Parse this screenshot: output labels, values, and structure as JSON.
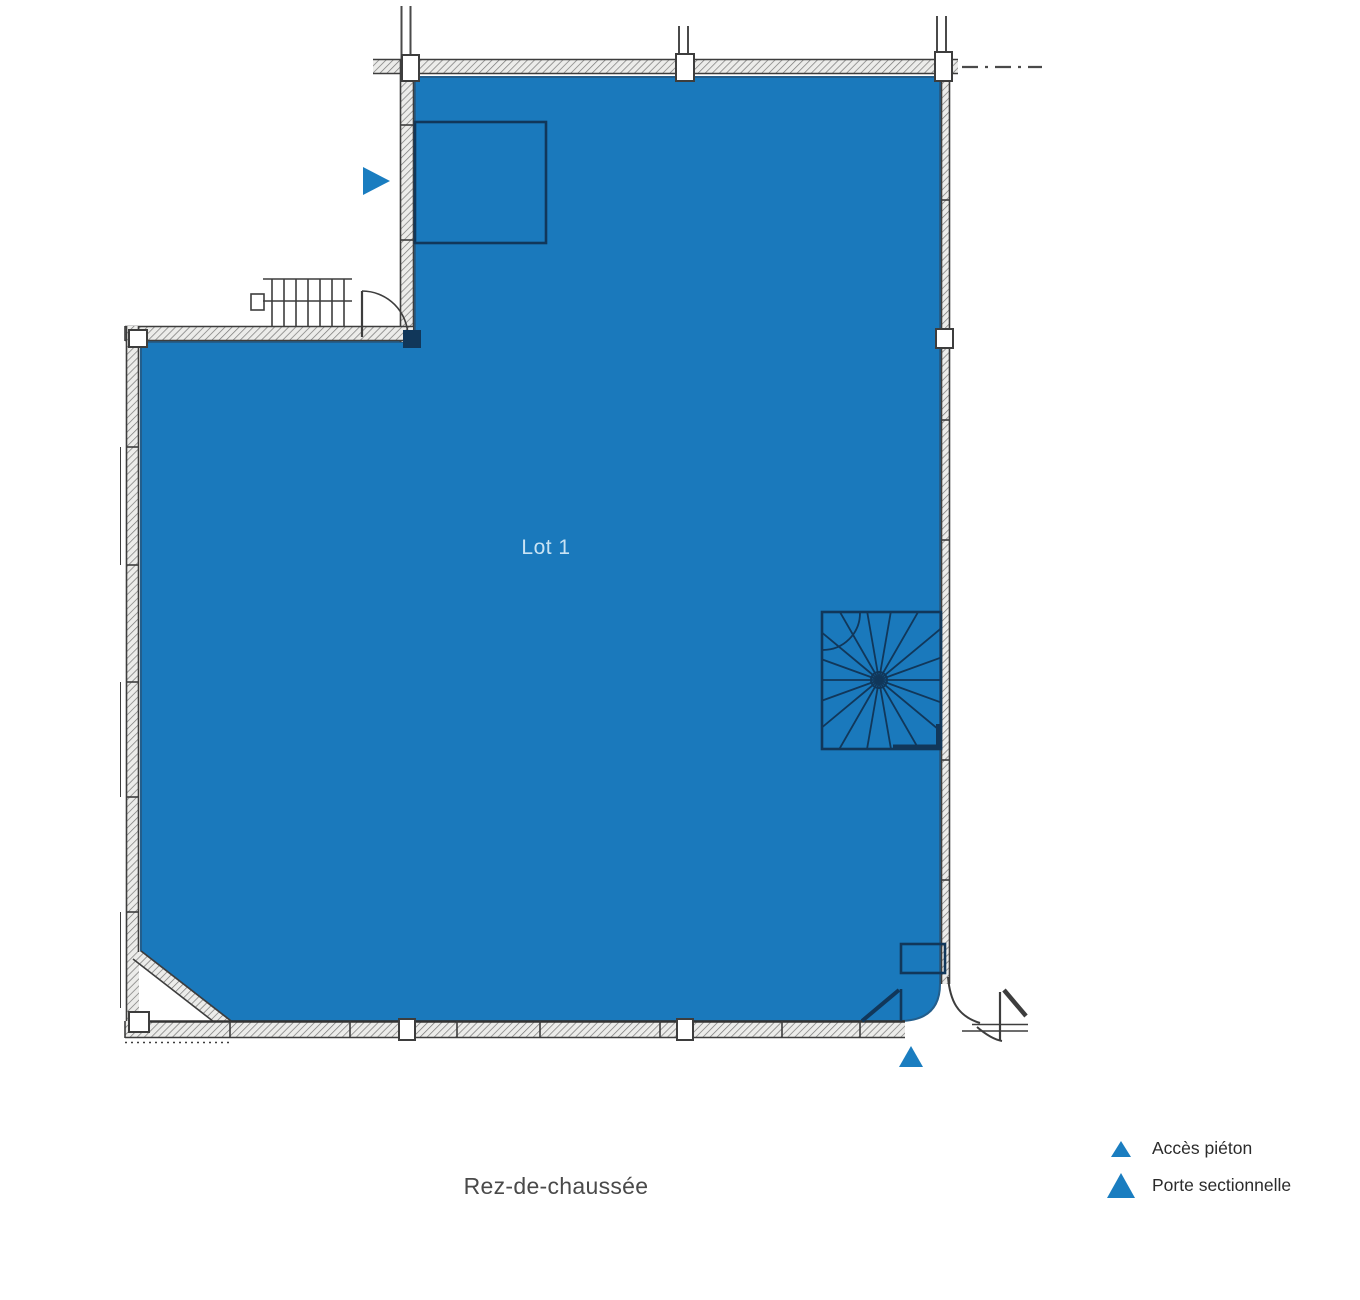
{
  "plan": {
    "lot_label": "Lot 1",
    "floor_caption": "Rez-de-chaussée"
  },
  "legend": {
    "items": [
      {
        "label": "Accès piéton",
        "marker": "small-blue-triangle-up"
      },
      {
        "label": "Porte sectionnelle",
        "marker": "large-blue-triangle-up"
      }
    ]
  },
  "colors": {
    "lot_fill": "#1a79bc",
    "lot_edge": "#235e8c",
    "lot_label": "#c9e3f4",
    "marker": "#1a7dc0",
    "furniture_line": "#11375a",
    "wall_line": "#3d3d3d",
    "caption": "#4a4a4a",
    "legend_text": "#2b2b2b"
  }
}
